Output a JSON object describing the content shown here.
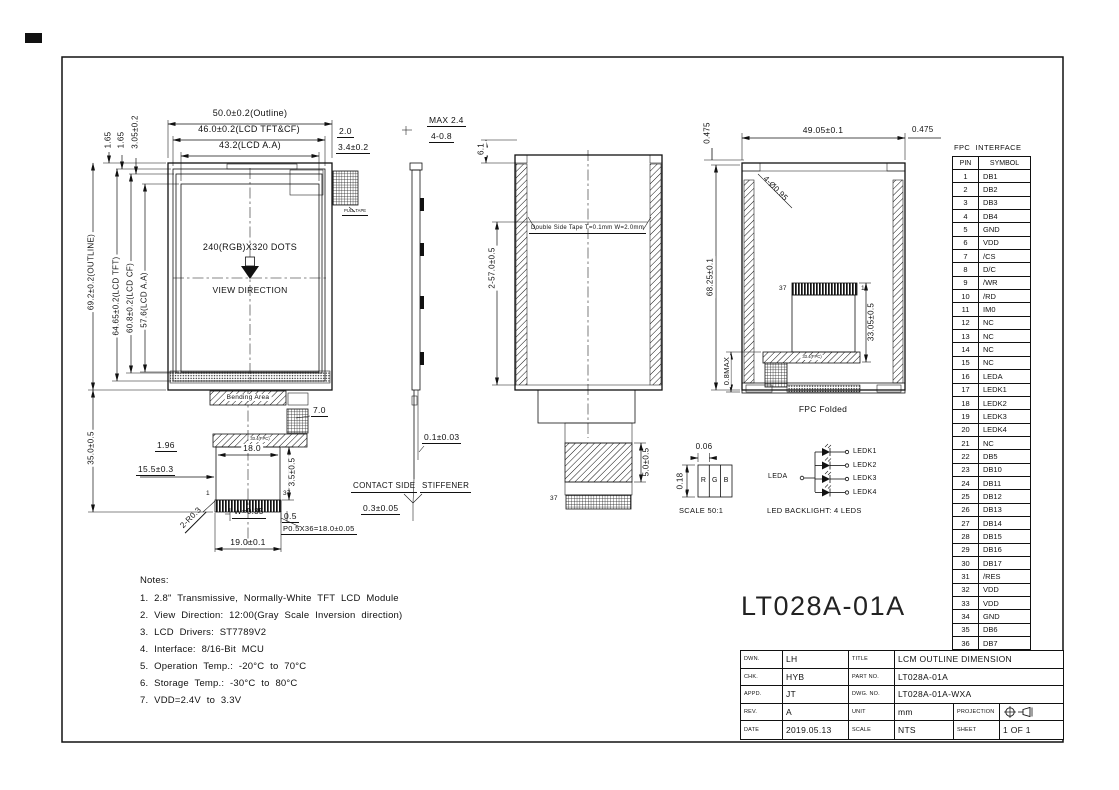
{
  "front_view": {
    "dim_outline_w": "50.0±0.2(Outline)",
    "dim_tft_w": "46.0±0.2(LCD TFT&CF)",
    "dim_aa_w": "43.2(LCD A.A)",
    "dim_gap1": "2.0",
    "dim_gap2": "3.4±0.2",
    "dim_t1": "1.65",
    "dim_t2": "1.65",
    "dim_t3": "3.05±0.2",
    "dim_outline_h": "69.2±0.2(OUTLINE)",
    "dim_tft_h": "64.65±0.2(LCD TFT)",
    "dim_cf_h": "60.8±0.2(LCD CF)",
    "dim_aa_h": "57.6(LCD A.A)",
    "dim_fpc_h": "35.0±0.5",
    "resolution": "240(RGB)X320 DOTS",
    "view_direction": "VIEW DIRECTION",
    "pull_tape": "PULL TAPE",
    "bending_area": "Bending Area",
    "fpc_bar": "33.4(FPC)",
    "dim_7": "7.0",
    "dim_196": "1.96",
    "dim_18": "18.0",
    "dim_155": "15.5±0.3",
    "dim_35t": "3.5±0.5",
    "pin_first": "1",
    "pin_last": "37",
    "dim_r": "2-R0.3",
    "dim_w": "W=0.35",
    "dim_05": "0.5",
    "dim_pitch": "P0.5X36=18.0±0.05",
    "dim_19": "19.0±0.1"
  },
  "side_view": {
    "dim_max": "MAX 2.4",
    "dim_tabs": "4-0.8",
    "dim_01": "0.1±0.03",
    "contact_side": "CONTACT SIDE",
    "stiffener": "STIFFENER",
    "dim_03": "0.3±0.05"
  },
  "section_view": {
    "dim_61": "6.1",
    "dim_57": "2-57.0±0.5",
    "tape": "Double Side Tape T=0.1mm W=2.0mm",
    "dim_50": "5.0±0.5",
    "pin_last": "37"
  },
  "back_view": {
    "dim_w": "49.05±0.1",
    "dim_off_l": "0.475",
    "dim_off_r": "0.475",
    "dim_holes": "4-Ø0.95",
    "dim_h": "68.25±0.1",
    "dim_08": "0.8MAX",
    "dim_330": "33.05±0.5",
    "pin_last": "37",
    "pin_first": "1",
    "fpc_bar": "33.4(FPC)",
    "caption": "FPC Folded"
  },
  "pixel_detail": {
    "dim_w": "0.06",
    "dim_h": "0.18",
    "r": "R",
    "g": "G",
    "b": "B",
    "caption": "SCALE 50:1"
  },
  "led_circuit": {
    "anode": "LEDA",
    "cathodes": [
      "LEDK1",
      "LEDK2",
      "LEDK3",
      "LEDK4"
    ],
    "caption": "LED BACKLIGHT: 4 LEDS"
  },
  "fpc_table": {
    "title": "FPC INTERFACE",
    "headers": [
      "PIN",
      "SYMBOL"
    ],
    "rows": [
      [
        "1",
        "DB1"
      ],
      [
        "2",
        "DB2"
      ],
      [
        "3",
        "DB3"
      ],
      [
        "4",
        "DB4"
      ],
      [
        "5",
        "GND"
      ],
      [
        "6",
        "VDD"
      ],
      [
        "7",
        "/CS"
      ],
      [
        "8",
        "D/C"
      ],
      [
        "9",
        "/WR"
      ],
      [
        "10",
        "/RD"
      ],
      [
        "11",
        "IM0"
      ],
      [
        "12",
        "NC"
      ],
      [
        "13",
        "NC"
      ],
      [
        "14",
        "NC"
      ],
      [
        "15",
        "NC"
      ],
      [
        "16",
        "LEDA"
      ],
      [
        "17",
        "LEDK1"
      ],
      [
        "18",
        "LEDK2"
      ],
      [
        "19",
        "LEDK3"
      ],
      [
        "20",
        "LEDK4"
      ],
      [
        "21",
        "NC"
      ],
      [
        "22",
        "DB5"
      ],
      [
        "23",
        "DB10"
      ],
      [
        "24",
        "DB11"
      ],
      [
        "25",
        "DB12"
      ],
      [
        "26",
        "DB13"
      ],
      [
        "27",
        "DB14"
      ],
      [
        "28",
        "DB15"
      ],
      [
        "29",
        "DB16"
      ],
      [
        "30",
        "DB17"
      ],
      [
        "31",
        "/RES"
      ],
      [
        "32",
        "VDD"
      ],
      [
        "33",
        "VDD"
      ],
      [
        "34",
        "GND"
      ],
      [
        "35",
        "DB6"
      ],
      [
        "36",
        "DB7"
      ],
      [
        "37",
        "DB8"
      ]
    ]
  },
  "notes": {
    "heading": "Notes:",
    "items": [
      "1. 2.8\" Transmissive, Normally-White TFT LCD Module",
      "2. View Direction: 12:00(Gray Scale Inversion direction)",
      "3. LCD Drivers: ST7789V2",
      "4. Interface: 8/16-Bit MCU",
      "5. Operation Temp.: -20°C to 70°C",
      "6. Storage Temp.: -30°C to 80°C",
      "7. VDD=2.4V to 3.3V"
    ]
  },
  "part_number_large": "LT028A-01A",
  "title_block": {
    "dwn_label": "DWN.",
    "dwn": "LH",
    "title_label": "TITLE",
    "title": "LCM OUTLINE DIMENSION",
    "chk_label": "CHK.",
    "chk": "HYB",
    "part_label": "PART NO.",
    "part": "LT028A-01A",
    "appd_label": "APPD.",
    "appd": "JT",
    "dwg_label": "DWG. NO.",
    "dwg": "LT028A-01A-WXA",
    "rev_label": "REV.",
    "rev": "A",
    "unit_label": "UNIT",
    "unit": "mm",
    "projection_label": "PROJECTION",
    "date_label": "DATE",
    "date": "2019.05.13",
    "scale_label": "SCALE",
    "scale": "NTS",
    "sheet_label": "SHEET",
    "sheet": "1 OF 1"
  }
}
